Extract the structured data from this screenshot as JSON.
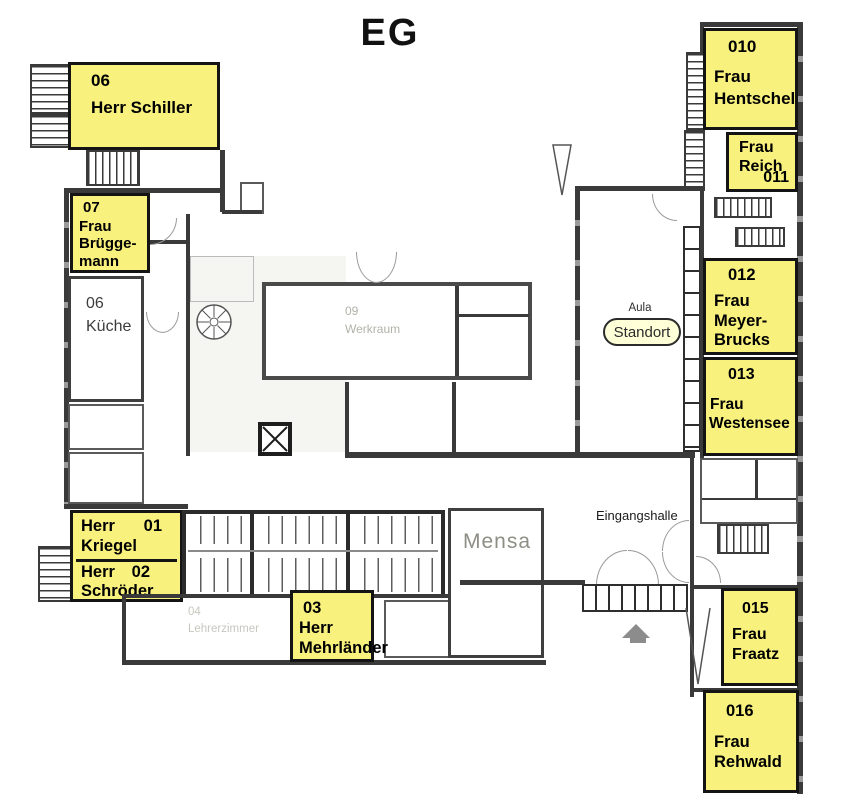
{
  "title": "EG",
  "marker": {
    "label": "Standort"
  },
  "colors": {
    "highlight": "#F8F17E",
    "wall": "#3A3A3A",
    "marker_fill": "#FFFFD8",
    "faint_text": "#B2B2AA"
  },
  "areas": {
    "aula": "Aula",
    "mensa": "Mensa",
    "eingangshalle": "Eingangshalle",
    "kueche_number": "06",
    "kueche_name": "Küche",
    "werkraum_number": "09",
    "werkraum_name": "Werkraum",
    "lehrerzimmer_number": "04",
    "lehrerzimmer_name": "Lehrerzimmer"
  },
  "rooms": {
    "schiller": {
      "number": "06",
      "lines": [
        "Herr Schiller"
      ]
    },
    "brueggemann": {
      "number": "07",
      "lines": [
        "Frau",
        "Brügge-",
        "mann"
      ]
    },
    "kriegel": {
      "number": "01",
      "lines": [
        "Herr",
        "Kriegel"
      ]
    },
    "schroeder": {
      "number": "02",
      "lines": [
        "Herr",
        "Schröder"
      ]
    },
    "mehrlaender": {
      "number": "03",
      "lines": [
        "Herr",
        "Mehrländer"
      ]
    },
    "hentschel": {
      "number": "010",
      "lines": [
        "Frau",
        "Hentschel"
      ]
    },
    "reich": {
      "number": "011",
      "lines": [
        "Frau",
        "Reich"
      ]
    },
    "meyerbrucks": {
      "number": "012",
      "lines": [
        "Frau",
        "Meyer-",
        "Brucks"
      ]
    },
    "westensee": {
      "number": "013",
      "lines": [
        "Frau",
        "Westensee"
      ]
    },
    "fraatz": {
      "number": "015",
      "lines": [
        "Frau",
        "Fraatz"
      ]
    },
    "rehwald": {
      "number": "016",
      "lines": [
        "Frau",
        "Rehwald"
      ]
    }
  }
}
